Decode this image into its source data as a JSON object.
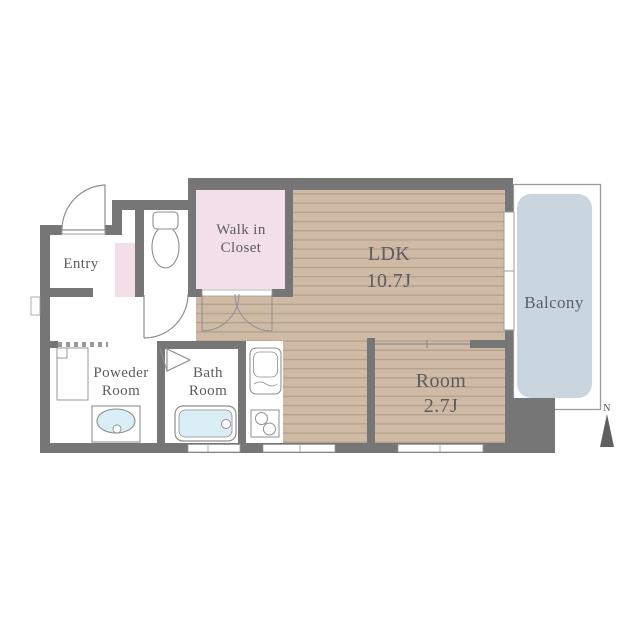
{
  "plan_title": "apartment-floor-plan",
  "rooms": {
    "entry": {
      "label": "Entry"
    },
    "walk_in_closet": {
      "label_line1": "Walk in",
      "label_line2": "Closet"
    },
    "ldk": {
      "label": "LDK",
      "size": "10.7J"
    },
    "room": {
      "label": "Room",
      "size": "2.7J"
    },
    "powder_room": {
      "label_line1": "Poweder",
      "label_line2": "Room"
    },
    "bath_room": {
      "label_line1": "Bath",
      "label_line2": "Room"
    },
    "balcony": {
      "label": "Balcony"
    }
  },
  "compass": {
    "north_label": "N"
  },
  "colors": {
    "wall": "#767676",
    "floor_wood": "#cfbaa6",
    "floor_wood_stripe": "#b6a18d",
    "closet_pink": "#f3dfe7",
    "balcony_blue": "#c9d6e0",
    "fixture_blue": "#daeef5",
    "fixture_outline": "#8f8f8f",
    "text": "#5c5c60",
    "background": "#ffffff"
  }
}
